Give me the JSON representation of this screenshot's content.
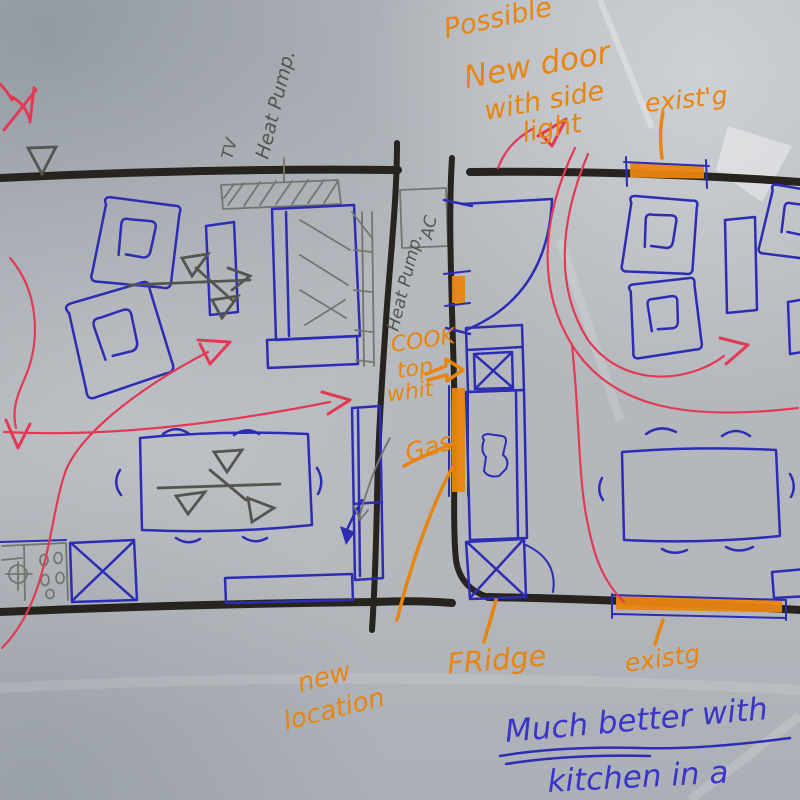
{
  "annotations": {
    "possible_new_door": [
      "Possible",
      "New door",
      "with side",
      "light"
    ],
    "existing_door_top": "exist'g",
    "tv_label": "TV",
    "heat_pump_wall": "Heat Pump.",
    "ac_unit": "AC",
    "heat_pump_center": "Heat Pump.",
    "cook_top": [
      "COOK",
      "top",
      "whit"
    ],
    "gas": "Gas",
    "new_location": [
      "new",
      "location"
    ],
    "fridge": "FRidge",
    "existing_door_bottom": "existg",
    "note": [
      "Much better with",
      "kitchen in a"
    ]
  },
  "colors": {
    "paper": "#b4b8bd",
    "wall_black": "#27231e",
    "pen_blue": "#2d2db4",
    "note_blue": "#3a35c8",
    "pen_red": "#e23a55",
    "pen_orange": "#e8850f",
    "pencil": "#75756f",
    "pencil_dark": "#55554f"
  }
}
